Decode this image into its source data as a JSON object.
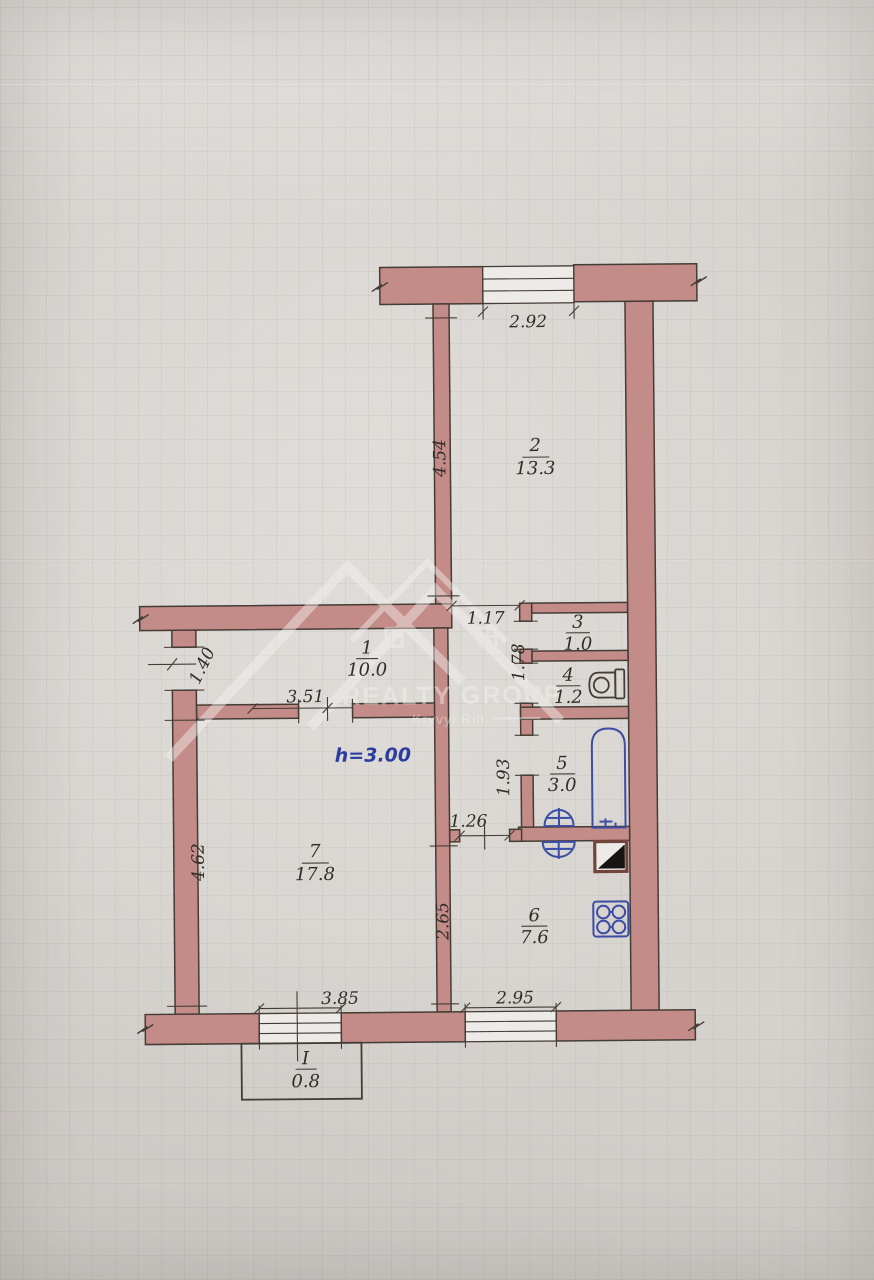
{
  "plan": {
    "ceiling_height": "h=3.00",
    "watermark": {
      "brand": "REALTY GROUP",
      "city": "Kryvyi Rih"
    },
    "rooms": [
      {
        "number": "1",
        "area": "10.0"
      },
      {
        "number": "2",
        "area": "13.3"
      },
      {
        "number": "3",
        "area": "1.0"
      },
      {
        "number": "4",
        "area": "1.2"
      },
      {
        "number": "5",
        "area": "3.0"
      },
      {
        "number": "6",
        "area": "7.6"
      },
      {
        "number": "7",
        "area": "17.8"
      }
    ],
    "balcony": {
      "number": "I",
      "area": "0.8"
    },
    "dimensions": {
      "top_window": "2.92",
      "room2_wall": "4.54",
      "passage": "1.17",
      "entrance": "1.40",
      "room1_wall": "3.51",
      "closet_wall": "1.78",
      "bath_wall": "1.93",
      "kitchen_door": "1.26",
      "kitchen_wall": "2.65",
      "room7_wall": "4.62",
      "room7_window": "3.85",
      "kitchen_window": "2.95"
    },
    "colors": {
      "wall": "#c38c89",
      "outline": "#453c35",
      "fixture": "#3c4da6",
      "height_text": "#2c3da0",
      "paper": "#d7d3cf",
      "text": "#312d29"
    }
  }
}
